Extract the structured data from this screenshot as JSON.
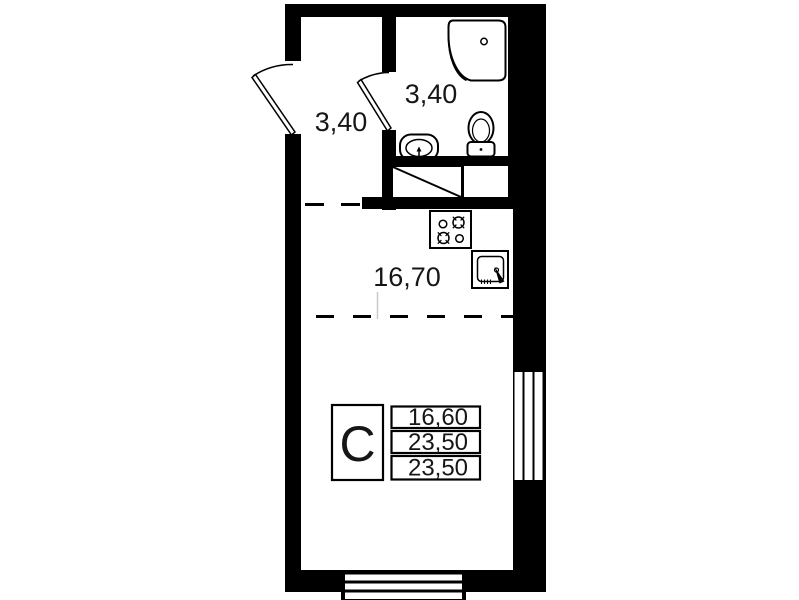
{
  "plan": {
    "colors": {
      "wall": "#000000",
      "background": "#ffffff",
      "line": "#000000",
      "faint_line": "#c8c8c8"
    },
    "rooms": {
      "hallway": {
        "area": "3,40"
      },
      "bathroom": {
        "area": "3,40"
      },
      "living_kitchen": {
        "area": "16,70"
      }
    },
    "summary_table": {
      "unit_type": "С",
      "values": [
        "16,60",
        "23,50",
        "23,50"
      ]
    },
    "fixtures": [
      "shower-tray-icon",
      "washbasin-icon",
      "toilet-icon",
      "wardrobe-icon",
      "stove-icon",
      "kitchen-sink-icon",
      "entry-door-swing",
      "bathroom-door-swing",
      "window-right",
      "window-bottom"
    ]
  }
}
